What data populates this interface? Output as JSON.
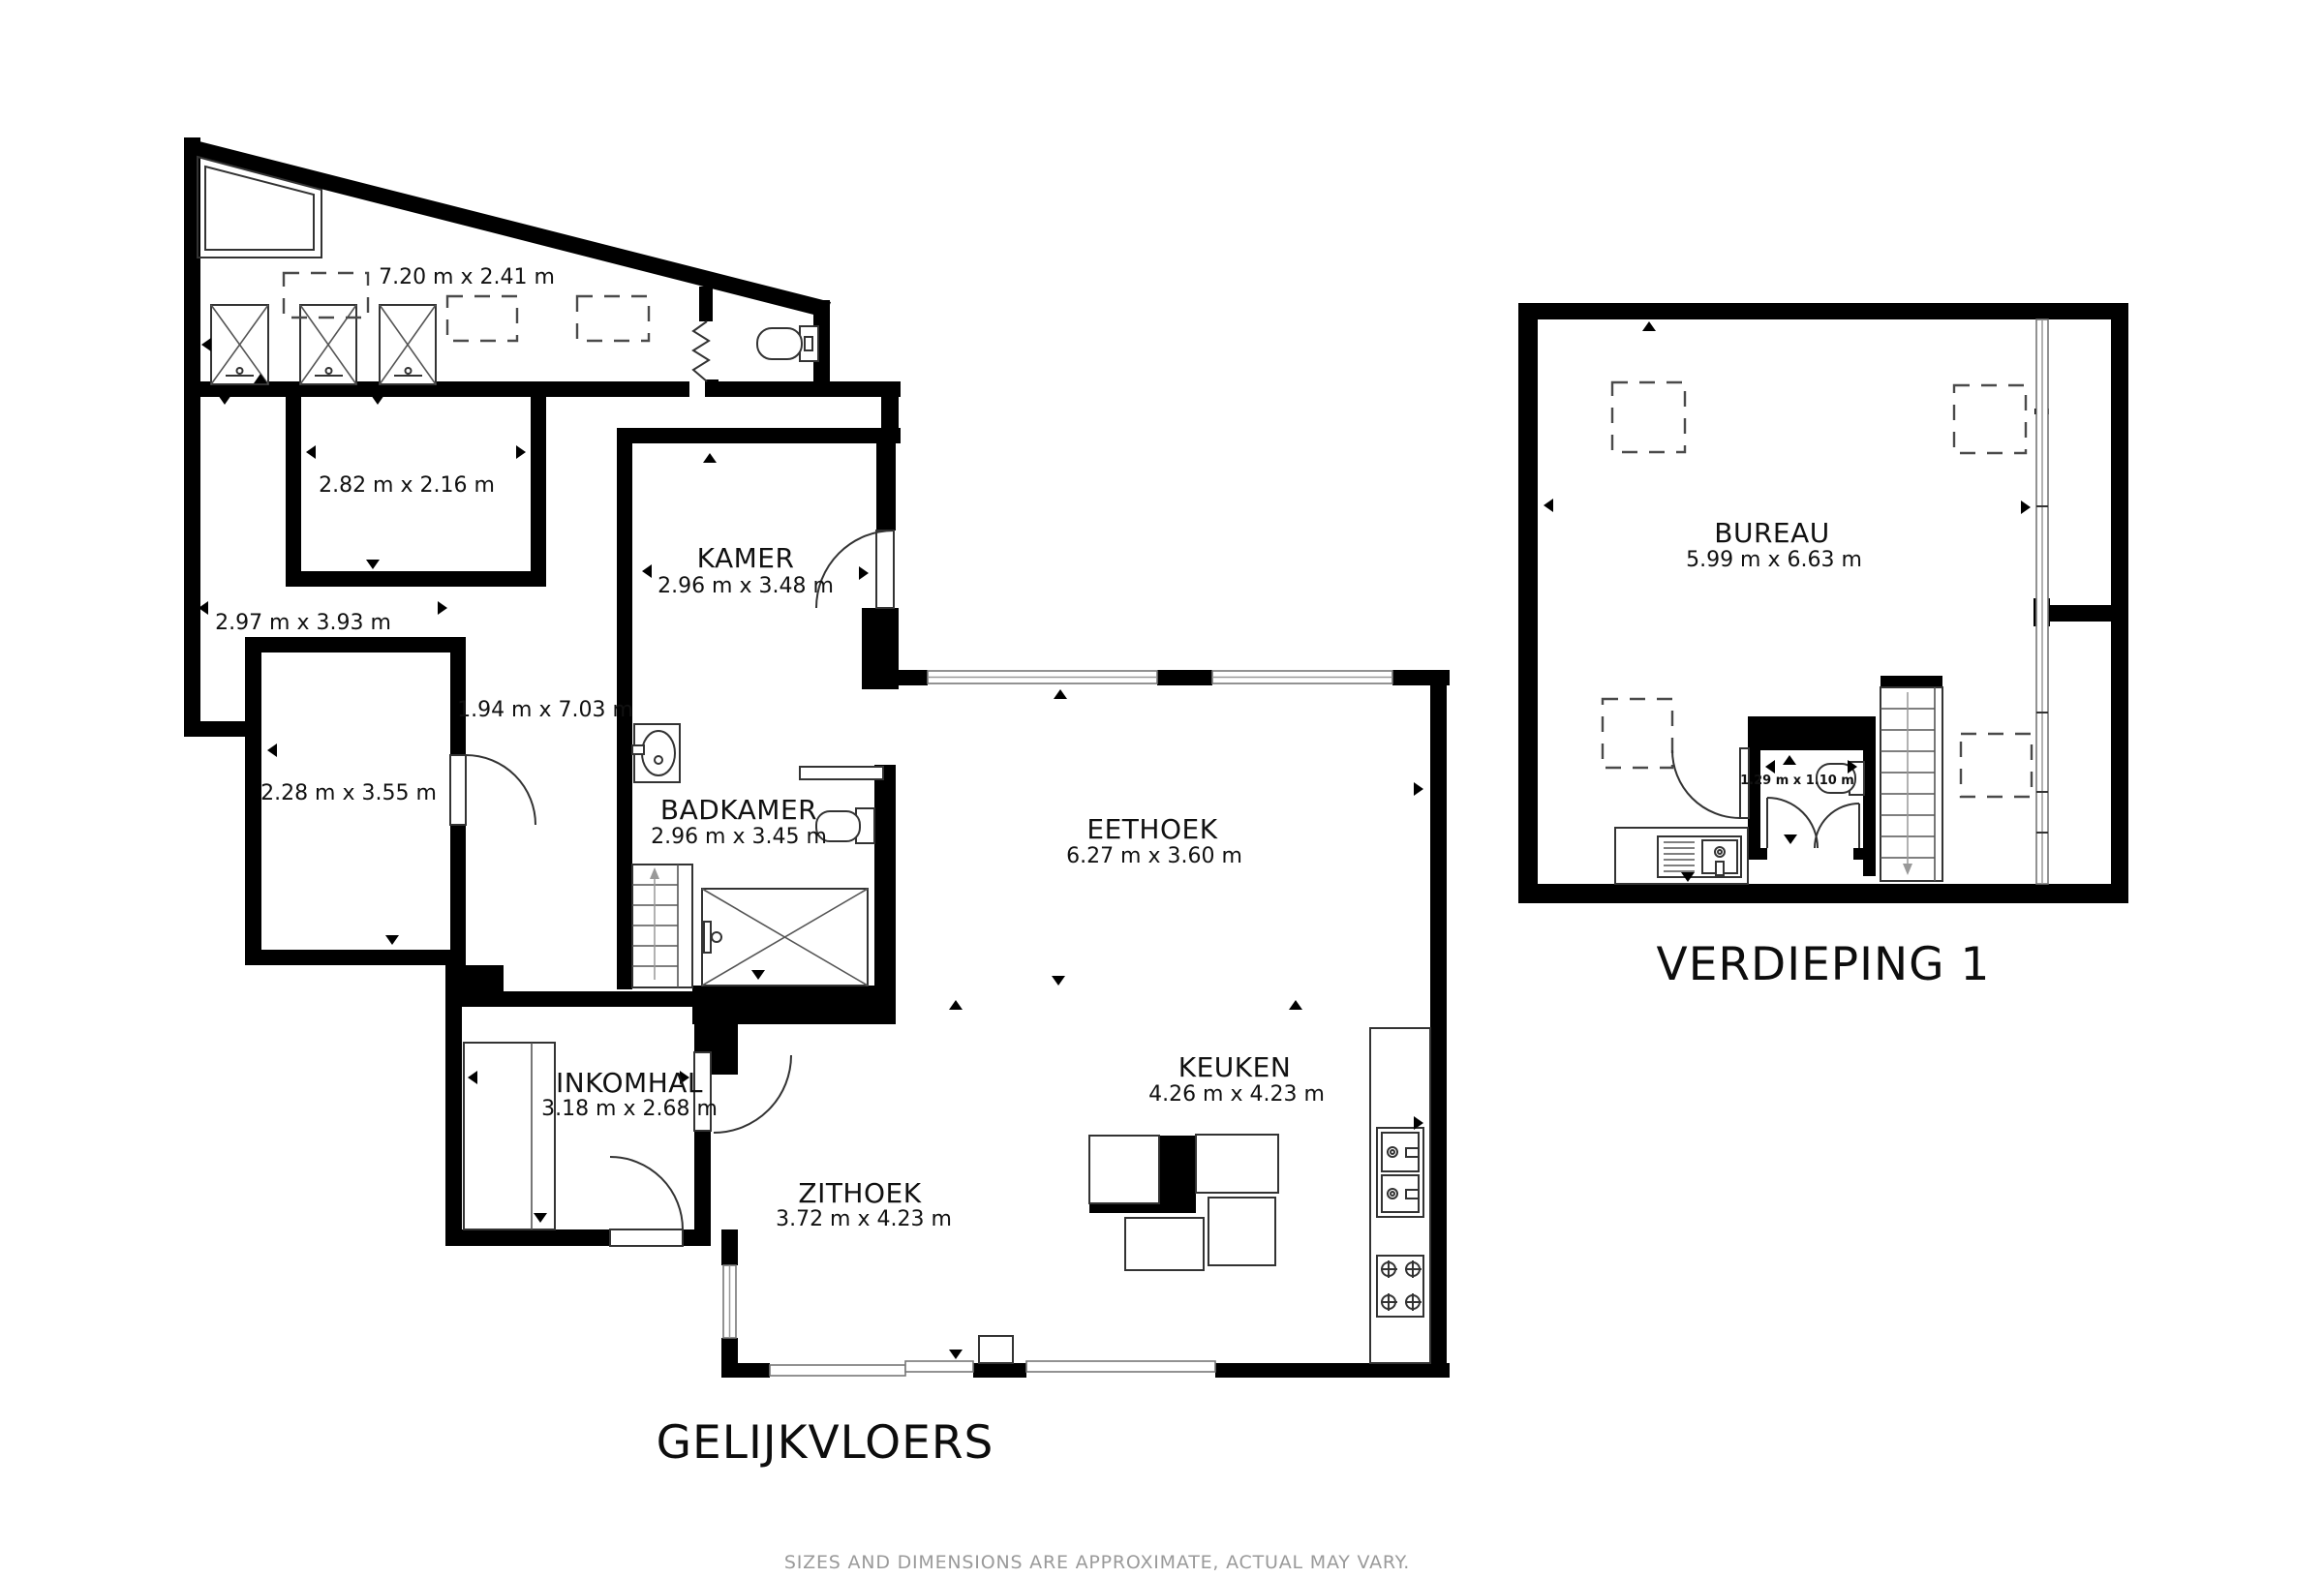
{
  "ground_floor": {
    "title": "GELIJKVLOERS",
    "storage_dims": "7.20 m x 2.41 m",
    "room_2_82_dims": "2.82 m x 2.16 m",
    "zone_2_97_dims": "2.97 m x 3.93 m",
    "room_2_28_dims": "2.28 m x 3.55 m",
    "hall_dims": "1.94 m x 7.03 m",
    "kamer": {
      "name": "KAMER",
      "dims": "2.96 m x 3.48 m"
    },
    "badkamer": {
      "name": "BADKAMER",
      "dims": "2.96 m x 3.45 m"
    },
    "eethoek": {
      "name": "EETHOEK",
      "dims": "6.27 m x 3.60 m"
    },
    "keuken": {
      "name": "KEUKEN",
      "dims": "4.26 m x 4.23 m"
    },
    "inkomhal": {
      "name": "INKOMHAL",
      "dims": "3.18 m x 2.68 m"
    },
    "zithoek": {
      "name": "ZITHOEK",
      "dims": "3.72 m x 4.23 m"
    }
  },
  "first_floor": {
    "title": "VERDIEPING 1",
    "bureau": {
      "name": "BUREAU",
      "dims": "5.99 m x 6.63 m"
    },
    "wc_dims": "1.29 m x 1.10 m"
  },
  "disclaimer": "SIZES AND DIMENSIONS ARE APPROXIMATE, ACTUAL MAY VARY.",
  "colors": {
    "wall": "#000000",
    "background": "#ffffff",
    "disclaimer_text": "#9a9a9a"
  }
}
